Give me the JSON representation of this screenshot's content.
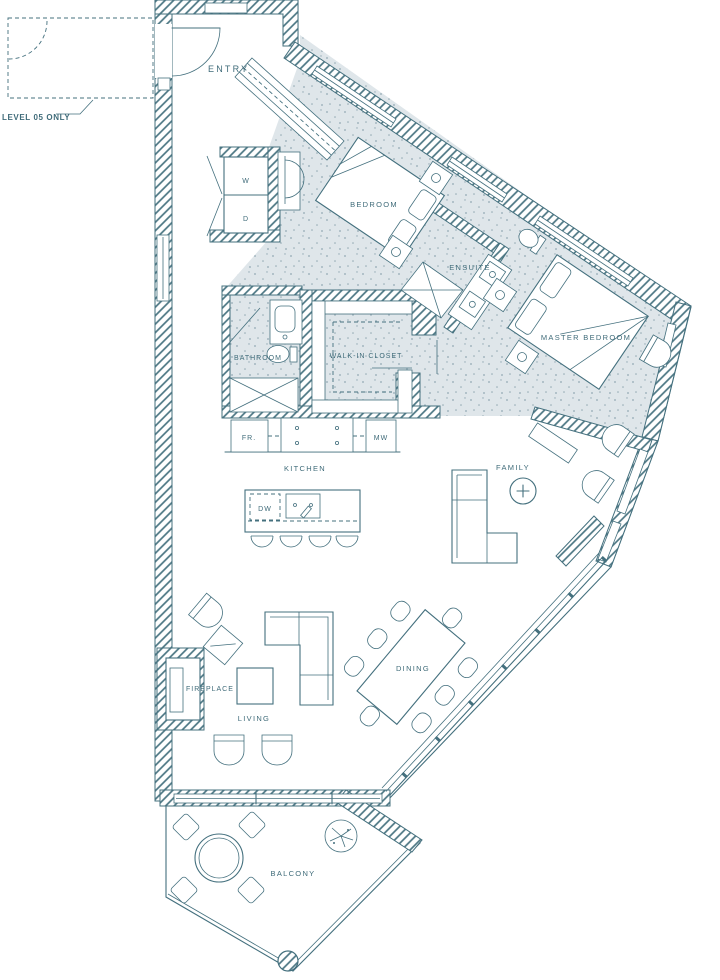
{
  "title": "Apartment floor plan",
  "annotations": {
    "level_note": "LEVEL 05 ONLY"
  },
  "rooms": {
    "entry": "ENTRY",
    "bedroom": "BEDROOM",
    "ensuite": "ENSUITE",
    "master_bedroom": "MASTER BEDROOM",
    "bathroom": "BATHROOM",
    "walk_in_closet": "WALK-IN CLOSET",
    "kitchen": "KITCHEN",
    "family": "FAMILY",
    "dining": "DINING",
    "living": "LIVING",
    "fireplace": "FIREPLACE",
    "balcony": "BALCONY"
  },
  "appliances": {
    "washer": "W",
    "dryer": "D",
    "fridge": "FR.",
    "microwave": "MW",
    "dishwasher": "DW"
  },
  "colors": {
    "ink": "#44707e",
    "text": "#3f6b79",
    "wood_floor_base": "#e4e9ec",
    "wood_floor_stripe": "#cbd5db",
    "carpet_base": "#dfe6ea",
    "carpet_dot": "#93a9b3",
    "balcony_tile_base": "#e6ebee",
    "balcony_tile_line": "#c3ced5",
    "background": "#ffffff"
  }
}
